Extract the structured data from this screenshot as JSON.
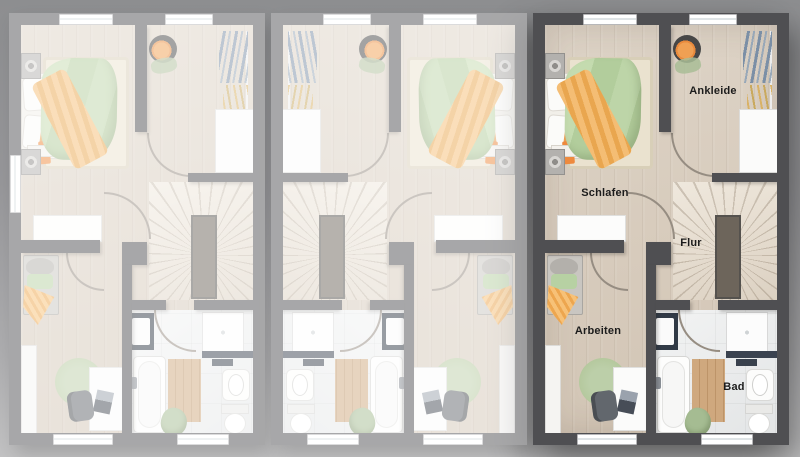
{
  "floorplan": {
    "kind": "row-house upper-floor plan, three adjoining units",
    "highlighted_unit": "right"
  },
  "units": [
    {
      "id": "left",
      "state": "inactive",
      "mirrored": false,
      "side_window": true,
      "rooms": {}
    },
    {
      "id": "middle",
      "state": "inactive",
      "mirrored": true,
      "side_window": false,
      "rooms": {}
    },
    {
      "id": "right",
      "state": "highlighted",
      "mirrored": false,
      "side_window": false,
      "rooms": {
        "schlafen": "Schlafen",
        "ankleide": "Ankleide",
        "flur": "Flur",
        "arbeiten": "Arbeiten",
        "bad": "Bad"
      }
    }
  ],
  "colors": {
    "background_top": "#8d8e90",
    "background_bottom": "#c2c2c3",
    "wall_active": "#4f4f52",
    "faded_overlay": "rgba(255,255,255,0.5)",
    "wood_floor": "#d7cbbc",
    "bath_floor": "#eceded",
    "stair_floor": "#e4dbcf",
    "duvet_green": "#b9d2a5",
    "blanket_orange": "#f0b163",
    "accent_orange_bright": "#ee8a3e",
    "vanity_navy": "#313a46",
    "rug_beige": "#eae2cf",
    "rug_green": "#b6c9a2",
    "wood_mat": "#c9a378",
    "label_text": "#1c1c1c"
  }
}
